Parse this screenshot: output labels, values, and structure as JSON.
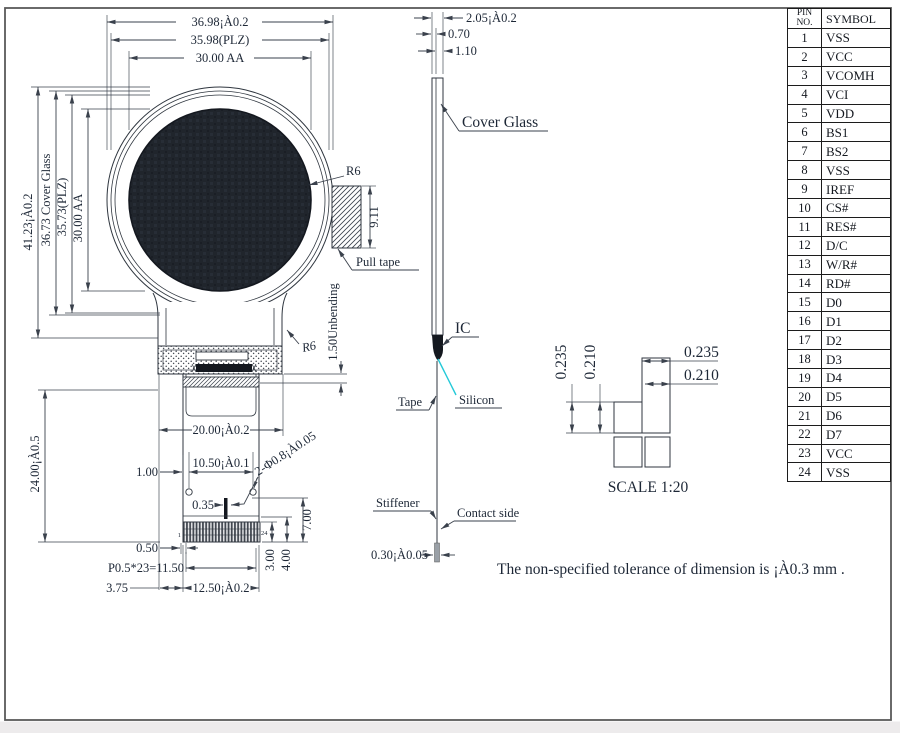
{
  "pin_table": {
    "header_no": "PIN NO.",
    "header_symbol": "SYMBOL",
    "rows": [
      {
        "no": "1",
        "symbol": "VSS"
      },
      {
        "no": "2",
        "symbol": "VCC"
      },
      {
        "no": "3",
        "symbol": "VCOMH"
      },
      {
        "no": "4",
        "symbol": "VCI"
      },
      {
        "no": "5",
        "symbol": "VDD"
      },
      {
        "no": "6",
        "symbol": "BS1"
      },
      {
        "no": "7",
        "symbol": "BS2"
      },
      {
        "no": "8",
        "symbol": "VSS"
      },
      {
        "no": "9",
        "symbol": "IREF"
      },
      {
        "no": "10",
        "symbol": "CS#"
      },
      {
        "no": "11",
        "symbol": "RES#"
      },
      {
        "no": "12",
        "symbol": "D/C"
      },
      {
        "no": "13",
        "symbol": "W/R#"
      },
      {
        "no": "14",
        "symbol": "RD#"
      },
      {
        "no": "15",
        "symbol": "D0"
      },
      {
        "no": "16",
        "symbol": "D1"
      },
      {
        "no": "17",
        "symbol": "D2"
      },
      {
        "no": "18",
        "symbol": "D3"
      },
      {
        "no": "19",
        "symbol": "D4"
      },
      {
        "no": "20",
        "symbol": "D5"
      },
      {
        "no": "21",
        "symbol": "D6"
      },
      {
        "no": "22",
        "symbol": "D7"
      },
      {
        "no": "23",
        "symbol": "VCC"
      },
      {
        "no": "24",
        "symbol": "VSS"
      }
    ]
  },
  "front_view": {
    "dim_width_total": "36.98¡À0.2",
    "dim_width_plz": "35.98(PLZ)",
    "dim_width_aa": "30.00 AA",
    "dim_height_total": "41.23¡À0.2",
    "dim_height_cover": "36.73 Cover Glass",
    "dim_height_plz": "35.73(PLZ)",
    "dim_height_aa": "30.00 AA",
    "dim_fpc_length": "24.00¡À0.5",
    "radius_top": "R6",
    "radius_bottom": "R6",
    "dim_pull_tape": "9.11",
    "label_pull_tape": "Pull tape",
    "label_unbending": "1.50Unbending",
    "dim_tail_width": "20.00¡À0.2",
    "dim_hole_pitch": "10.50¡À0.1",
    "dim_edge_hole": "1.00",
    "dim_slot": "0.35",
    "dim_holes": "2-Φ0.8¡À0.05",
    "dim_contact_7": "7.00",
    "dim_contact_3": "3.00",
    "dim_contact_4": "4.00",
    "dim_half": "0.50",
    "dim_pin_pitch": "P0.5*23=11.50",
    "dim_connector": "12.50¡À0.2",
    "dim_375": "3.75",
    "pin_first": "1",
    "pin_last": "24"
  },
  "side_view": {
    "dim_total": "2.05¡À0.2",
    "dim_panel": "0.70",
    "dim_glass": "1.10",
    "label_cover_glass": "Cover Glass",
    "label_ic": "IC",
    "label_tape": "Tape",
    "label_silicon": "Silicon",
    "label_stiffener": "Stiffener",
    "label_contact": "Contact side",
    "dim_stiffener": "0.30¡À0.05"
  },
  "detail_view": {
    "dim_v1": "0.235",
    "dim_v2": "0.210",
    "dim_h1": "0.235",
    "dim_h2": "0.210",
    "scale_label": "SCALE 1:20"
  },
  "note": "The non-specified tolerance of dimension is ¡À0.3 mm .",
  "colors": {
    "line": "#3a414c",
    "text": "#1d2736",
    "active_area": "#20252c",
    "silicon": "#25c9d8"
  }
}
